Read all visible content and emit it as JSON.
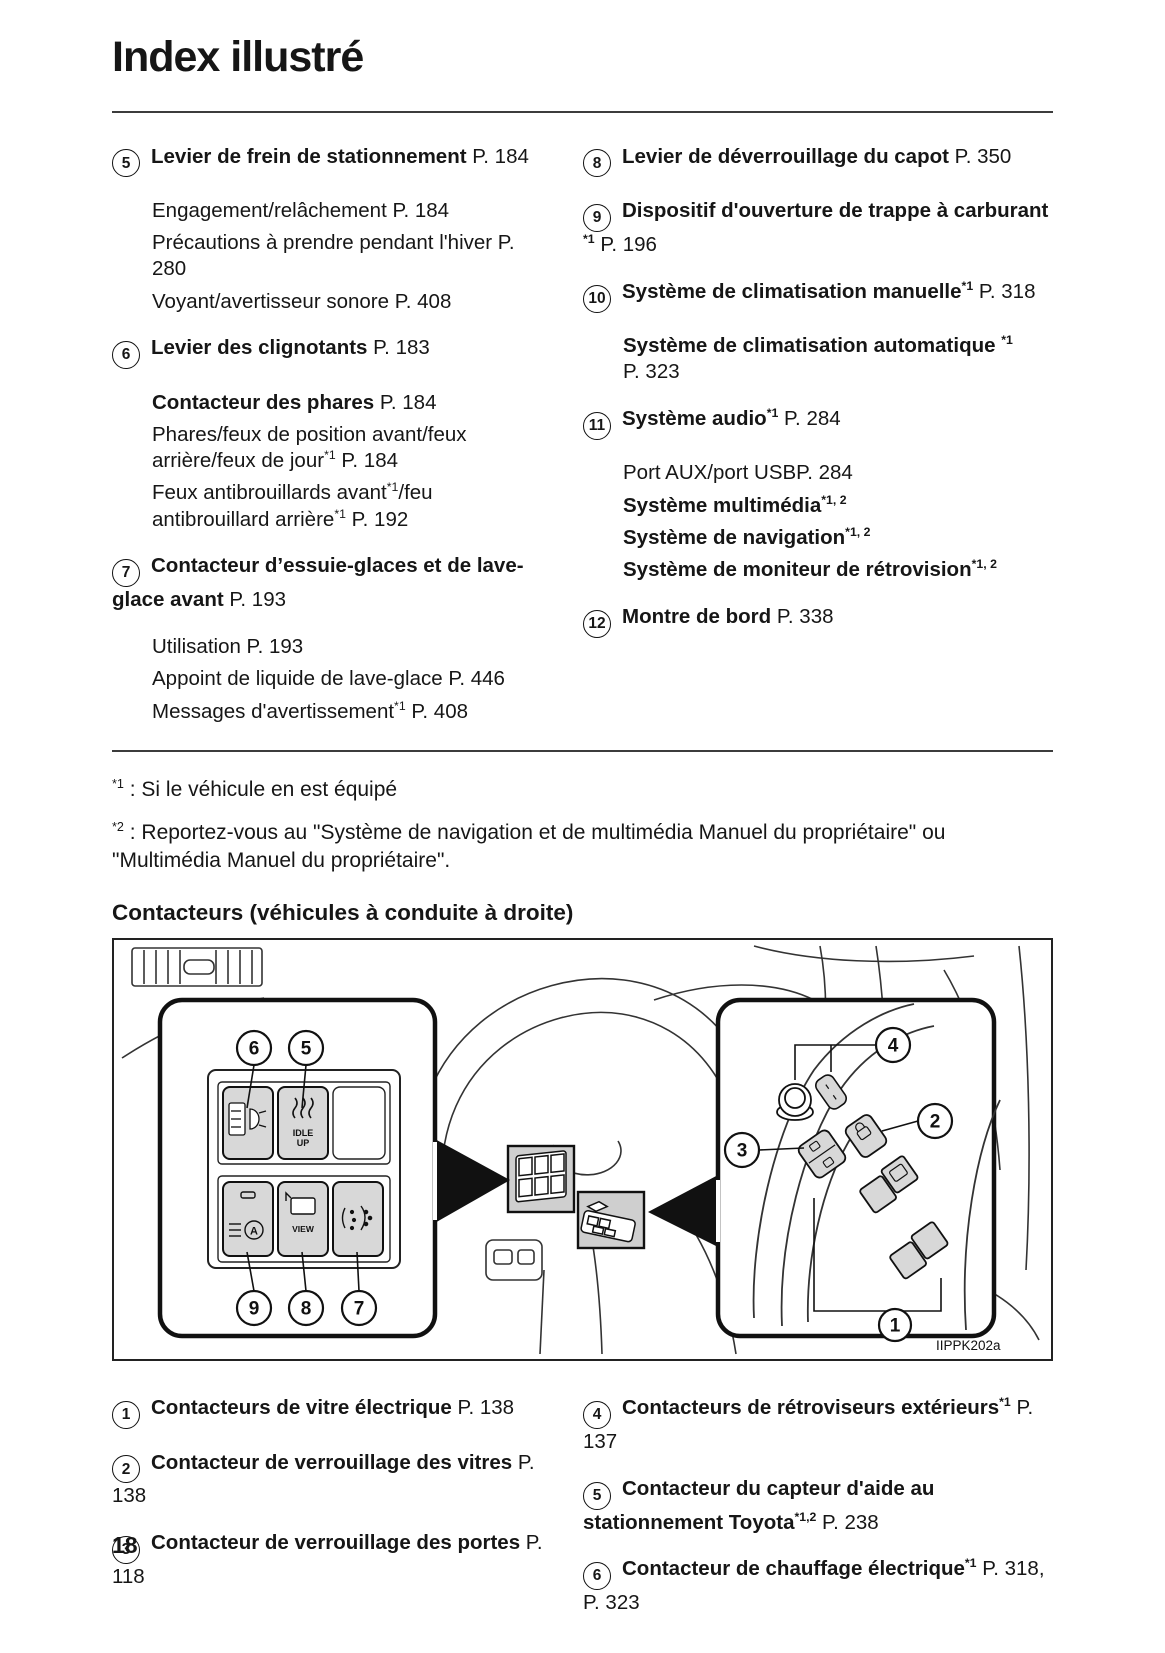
{
  "page": {
    "title": "Index illustré",
    "section_heading": "Contacteurs (véhicules à conduite à droite)",
    "page_number": "18"
  },
  "footnotes": {
    "f1": {
      "sup": "*1",
      "text": " : Si le véhicule en est équipé"
    },
    "f2": {
      "sup": "*2",
      "text": " : Reportez-vous au \"Système de navigation et de multimédia Manuel du propriétaire\" ou \"Multimédia Manuel du propriétaire\"."
    }
  },
  "index_top": {
    "left": [
      {
        "num": "5",
        "head": [
          {
            "t": "Levier de frein de stationnement",
            "b": true
          },
          {
            "t": " P. 184"
          }
        ],
        "subs": [
          [
            {
              "t": "Engagement/relâchement P. 184"
            }
          ],
          [
            {
              "t": "Précautions à prendre pendant l'hiver P. 280"
            }
          ],
          [
            {
              "t": "Voyant/avertisseur sonore P. 408"
            }
          ]
        ]
      },
      {
        "num": "6",
        "head": [
          {
            "t": "Levier des clignotants",
            "b": true
          },
          {
            "t": " P. 183"
          }
        ],
        "subs": [
          [
            {
              "t": "Contacteur des phares",
              "b": true
            },
            {
              "t": " P. 184"
            }
          ],
          [
            {
              "t": "Phares/feux de position avant/feux arrière/feux de jour"
            },
            {
              "t": "*1",
              "s": true
            },
            {
              "t": " P. 184"
            }
          ],
          [
            {
              "t": "Feux antibrouillards avant"
            },
            {
              "t": "*1",
              "s": true
            },
            {
              "t": "/feu antibrouillard arrière"
            },
            {
              "t": "*1",
              "s": true
            },
            {
              "t": " P. 192"
            }
          ]
        ]
      },
      {
        "num": "7",
        "head": [
          {
            "t": "Contacteur d’essuie-glaces et de lave-glace avant",
            "b": true
          },
          {
            "t": " P. 193"
          }
        ],
        "subs": [
          [
            {
              "t": "Utilisation P. 193"
            }
          ],
          [
            {
              "t": "Appoint de liquide de lave-glace P. 446"
            }
          ],
          [
            {
              "t": "Messages d'avertissement"
            },
            {
              "t": "*1",
              "s": true
            },
            {
              "t": " P. 408"
            }
          ]
        ]
      }
    ],
    "right": [
      {
        "num": "8",
        "head": [
          {
            "t": "Levier de déverrouillage du capot",
            "b": true
          },
          {
            "t": " P. 350"
          }
        ]
      },
      {
        "num": "9",
        "head": [
          {
            "t": "Dispositif d'ouverture de trappe à carburant ",
            "b": true
          },
          {
            "t": "*1",
            "b": true,
            "s": true
          },
          {
            "t": " P. 196"
          }
        ]
      },
      {
        "num": "10",
        "head": [
          {
            "t": "Système de climatisation manuelle",
            "b": true
          },
          {
            "t": "*1",
            "b": true,
            "s": true
          },
          {
            "t": " P. 318"
          }
        ],
        "subs": [
          [
            {
              "t": "Système de climatisation automatique ",
              "b": true
            },
            {
              "t": "*1",
              "b": true,
              "s": true
            },
            {
              "t": " P. 323"
            }
          ]
        ]
      },
      {
        "num": "11",
        "head": [
          {
            "t": "Système audio",
            "b": true
          },
          {
            "t": "*1",
            "b": true,
            "s": true
          },
          {
            "t": " P. 284"
          }
        ],
        "subs": [
          [
            {
              "t": "Port AUX/port USBP. 284"
            }
          ],
          [
            {
              "t": "Système multimédia",
              "b": true
            },
            {
              "t": "*1, 2",
              "b": true,
              "s": true
            }
          ],
          [
            {
              "t": "Système de navigation",
              "b": true
            },
            {
              "t": "*1, 2",
              "b": true,
              "s": true
            }
          ],
          [
            {
              "t": "Système de moniteur de rétrovision",
              "b": true
            },
            {
              "t": "*1, 2",
              "b": true,
              "s": true
            }
          ]
        ]
      },
      {
        "num": "12",
        "head": [
          {
            "t": "Montre de bord",
            "b": true
          },
          {
            "t": " P. 338"
          }
        ]
      }
    ]
  },
  "index_bottom": {
    "left": [
      {
        "num": "1",
        "head": [
          {
            "t": "Contacteurs de vitre électrique",
            "b": true
          },
          {
            "t": " P. 138"
          }
        ]
      },
      {
        "num": "2",
        "head": [
          {
            "t": "Contacteur de verrouillage des vitres",
            "b": true
          },
          {
            "t": " P. 138"
          }
        ]
      },
      {
        "num": "3",
        "head": [
          {
            "t": "Contacteur de verrouillage des portes",
            "b": true
          },
          {
            "t": " P. 118"
          }
        ]
      }
    ],
    "right": [
      {
        "num": "4",
        "head": [
          {
            "t": "Contacteurs de rétroviseurs extérieurs",
            "b": true
          },
          {
            "t": "*1",
            "b": true,
            "s": true
          },
          {
            "t": " P. 137"
          }
        ]
      },
      {
        "num": "5",
        "head": [
          {
            "t": "Contacteur du capteur d'aide au stationnement Toyota",
            "b": true
          },
          {
            "t": "*1,2",
            "b": true,
            "s": true
          },
          {
            "t": " P. 238"
          }
        ]
      },
      {
        "num": "6",
        "head": [
          {
            "t": "Contacteur de chauffage électrique",
            "b": true
          },
          {
            "t": "*1",
            "b": true,
            "s": true
          },
          {
            "t": " P. 318, P. 323"
          }
        ]
      }
    ]
  },
  "figure": {
    "code": "IIPPK202a",
    "left_panel": {
      "callouts": [
        "6",
        "5",
        "9",
        "8",
        "7"
      ],
      "idle_up": [
        "IDLE",
        "UP"
      ],
      "view_label": "VIEW",
      "auto_letter": "A"
    },
    "right_panel": {
      "callouts": [
        "4",
        "2",
        "3",
        "1"
      ]
    }
  }
}
